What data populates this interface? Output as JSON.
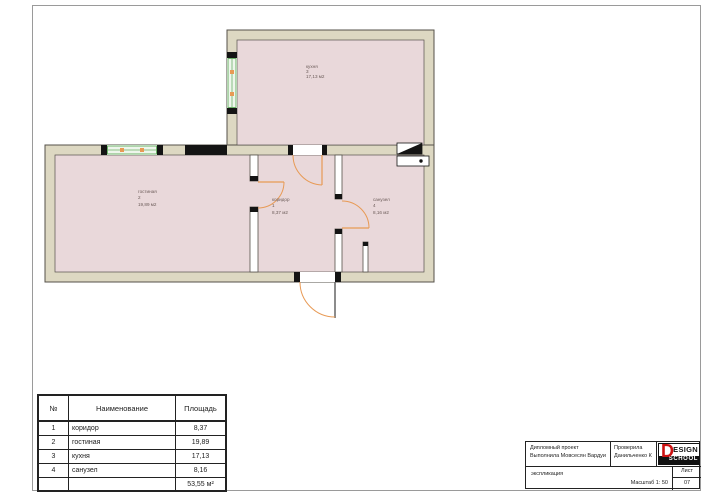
{
  "colors": {
    "wall_fill": "#ddd8c2",
    "wall_stroke": "#55514a",
    "room_fill": "#e9d8da",
    "window_green": "#6db269",
    "window_fill": "#eef6ec",
    "door_orange": "#e89a55",
    "black": "#141414",
    "frame_gray": "#9a9a9a",
    "label": "#6b5b58",
    "logo_red": "#cc1111"
  },
  "plan": {
    "rooms": [
      {
        "name": "кухня",
        "number": "3",
        "area": "17,13 м2"
      },
      {
        "name": "гостиная",
        "number": "2",
        "area": "19,89 м2"
      },
      {
        "name": "коридор",
        "number": "1",
        "area": "8,37 м2"
      },
      {
        "name": "санузел",
        "number": "4",
        "area": "8,16 м2"
      }
    ]
  },
  "table": {
    "headers": {
      "num": "№",
      "name": "Наименование",
      "area": "Площадь"
    },
    "rows": [
      {
        "num": "1",
        "name": "коридор",
        "area": "8,37"
      },
      {
        "num": "2",
        "name": "гостиная",
        "area": "19,89"
      },
      {
        "num": "3",
        "name": "кухня",
        "area": "17,13"
      },
      {
        "num": "4",
        "name": "санузел",
        "area": "8,16"
      }
    ],
    "total": "53,55 м²"
  },
  "titleblock": {
    "project_line1": "Дипломный проект",
    "project_line2": "Выполнила Мовсесян Вардуи",
    "checked_line1": "Проверила",
    "checked_line2": "Данильченко К",
    "doc_type": "экспликация",
    "scale": "Масштаб 1: 50",
    "sheet_label": "Лист",
    "sheet_number": "07",
    "logo": {
      "d": "D",
      "esign": "ESIGN",
      "school": "SCHOOL"
    }
  }
}
